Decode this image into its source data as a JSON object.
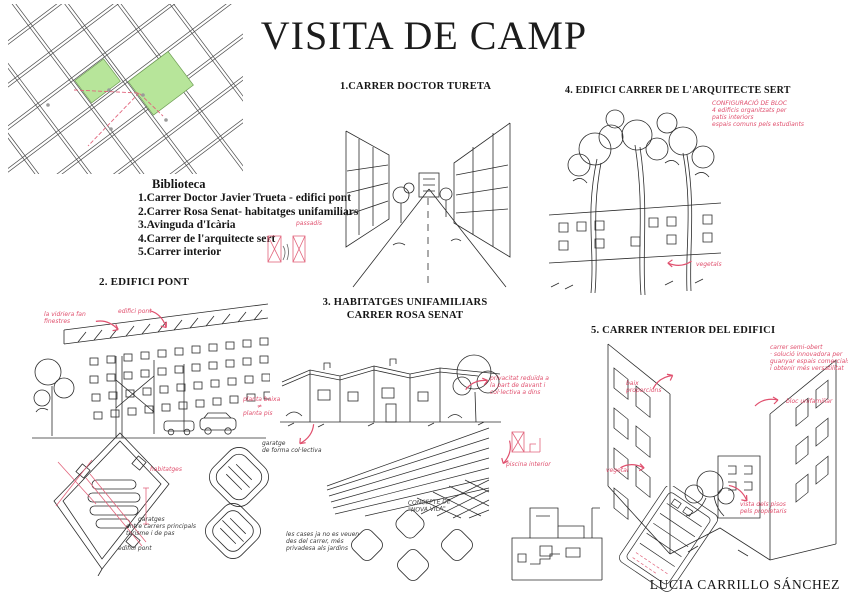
{
  "title": "VISITA DE CAMP",
  "signature": "LUCIA CARRILLO SÁNCHEZ",
  "colors": {
    "ink": "#2b2b2b",
    "annotation_red": "#e0506e",
    "map_green": "#b7e59a"
  },
  "legend": {
    "heading": "Biblioteca",
    "items": [
      "1.Carrer Doctor Javier Trueta - edifici pont",
      "2.Carrer Rosa Senat- habitatges unifamiliars",
      "3.Avinguda d'Icària",
      "4.Carrer de l'arquitecte sert",
      "5.Carrer interior"
    ]
  },
  "panels": {
    "p1": {
      "title": "1.CARRER DOCTOR TURETA",
      "note_passadis": "passadís"
    },
    "p2": {
      "title": "2. EDIFICI PONT",
      "note_glass_1": "la vidriera fan",
      "note_glass_2": "finestres",
      "note_bridge": "edifici pont",
      "note_floors_1": "planta baixa",
      "note_floors_2": "≠",
      "note_floors_3": "planta pis",
      "note_garage_1": "garatge",
      "note_garage_2": "de forma col·lectiva",
      "note_housing": "habitatges",
      "note_streets_1": "garatges",
      "note_streets_2": "entre carrers principals",
      "note_streets_3": "turisme i de pas",
      "note_bridge2": "edifici pont"
    },
    "p3": {
      "title_1": "3. HABITATGES UNIFAMILIARS",
      "title_2": "CARRER ROSA SENAT",
      "note_privacy_1": "privacitat reduïda a",
      "note_privacy_2": "la part de davant i",
      "note_privacy_3": "col·lectiva a dins",
      "note_pool": "piscina interior",
      "note_left_1": "les cases ja no es veuen",
      "note_left_2": "des del carrer, més",
      "note_left_3": "privadesa als jardins",
      "note_concept_1": "CONCEPTE DE",
      "note_concept_2": "\"NOVA VILA\""
    },
    "p4": {
      "title": "4. EDIFICI  CARRER DE L'ARQUITECTE SERT",
      "note_block_1": "CONFIGURACIÓ DE BLOC",
      "note_block_2": "4 edificis organitzats per",
      "note_block_3": "patis interiors",
      "note_block_4": "espais comuns pels estudiants",
      "note_veg": "vegetals"
    },
    "p5": {
      "title": "5. CARRER INTERIOR DEL EDIFICI",
      "note_open_1": "carrer semi-obert",
      "note_open_2": "· solució innovadora per",
      "note_open_3": "guanyar espais comercials",
      "note_open_4": "i obtenir més versatilitat",
      "note_prop_1": "baix",
      "note_prop_2": "proporcions",
      "note_unif": "bloc unifamiliar",
      "note_veg": "vegetal",
      "note_view_1": "vista dels pisos",
      "note_view_2": "pels propietaris"
    }
  }
}
